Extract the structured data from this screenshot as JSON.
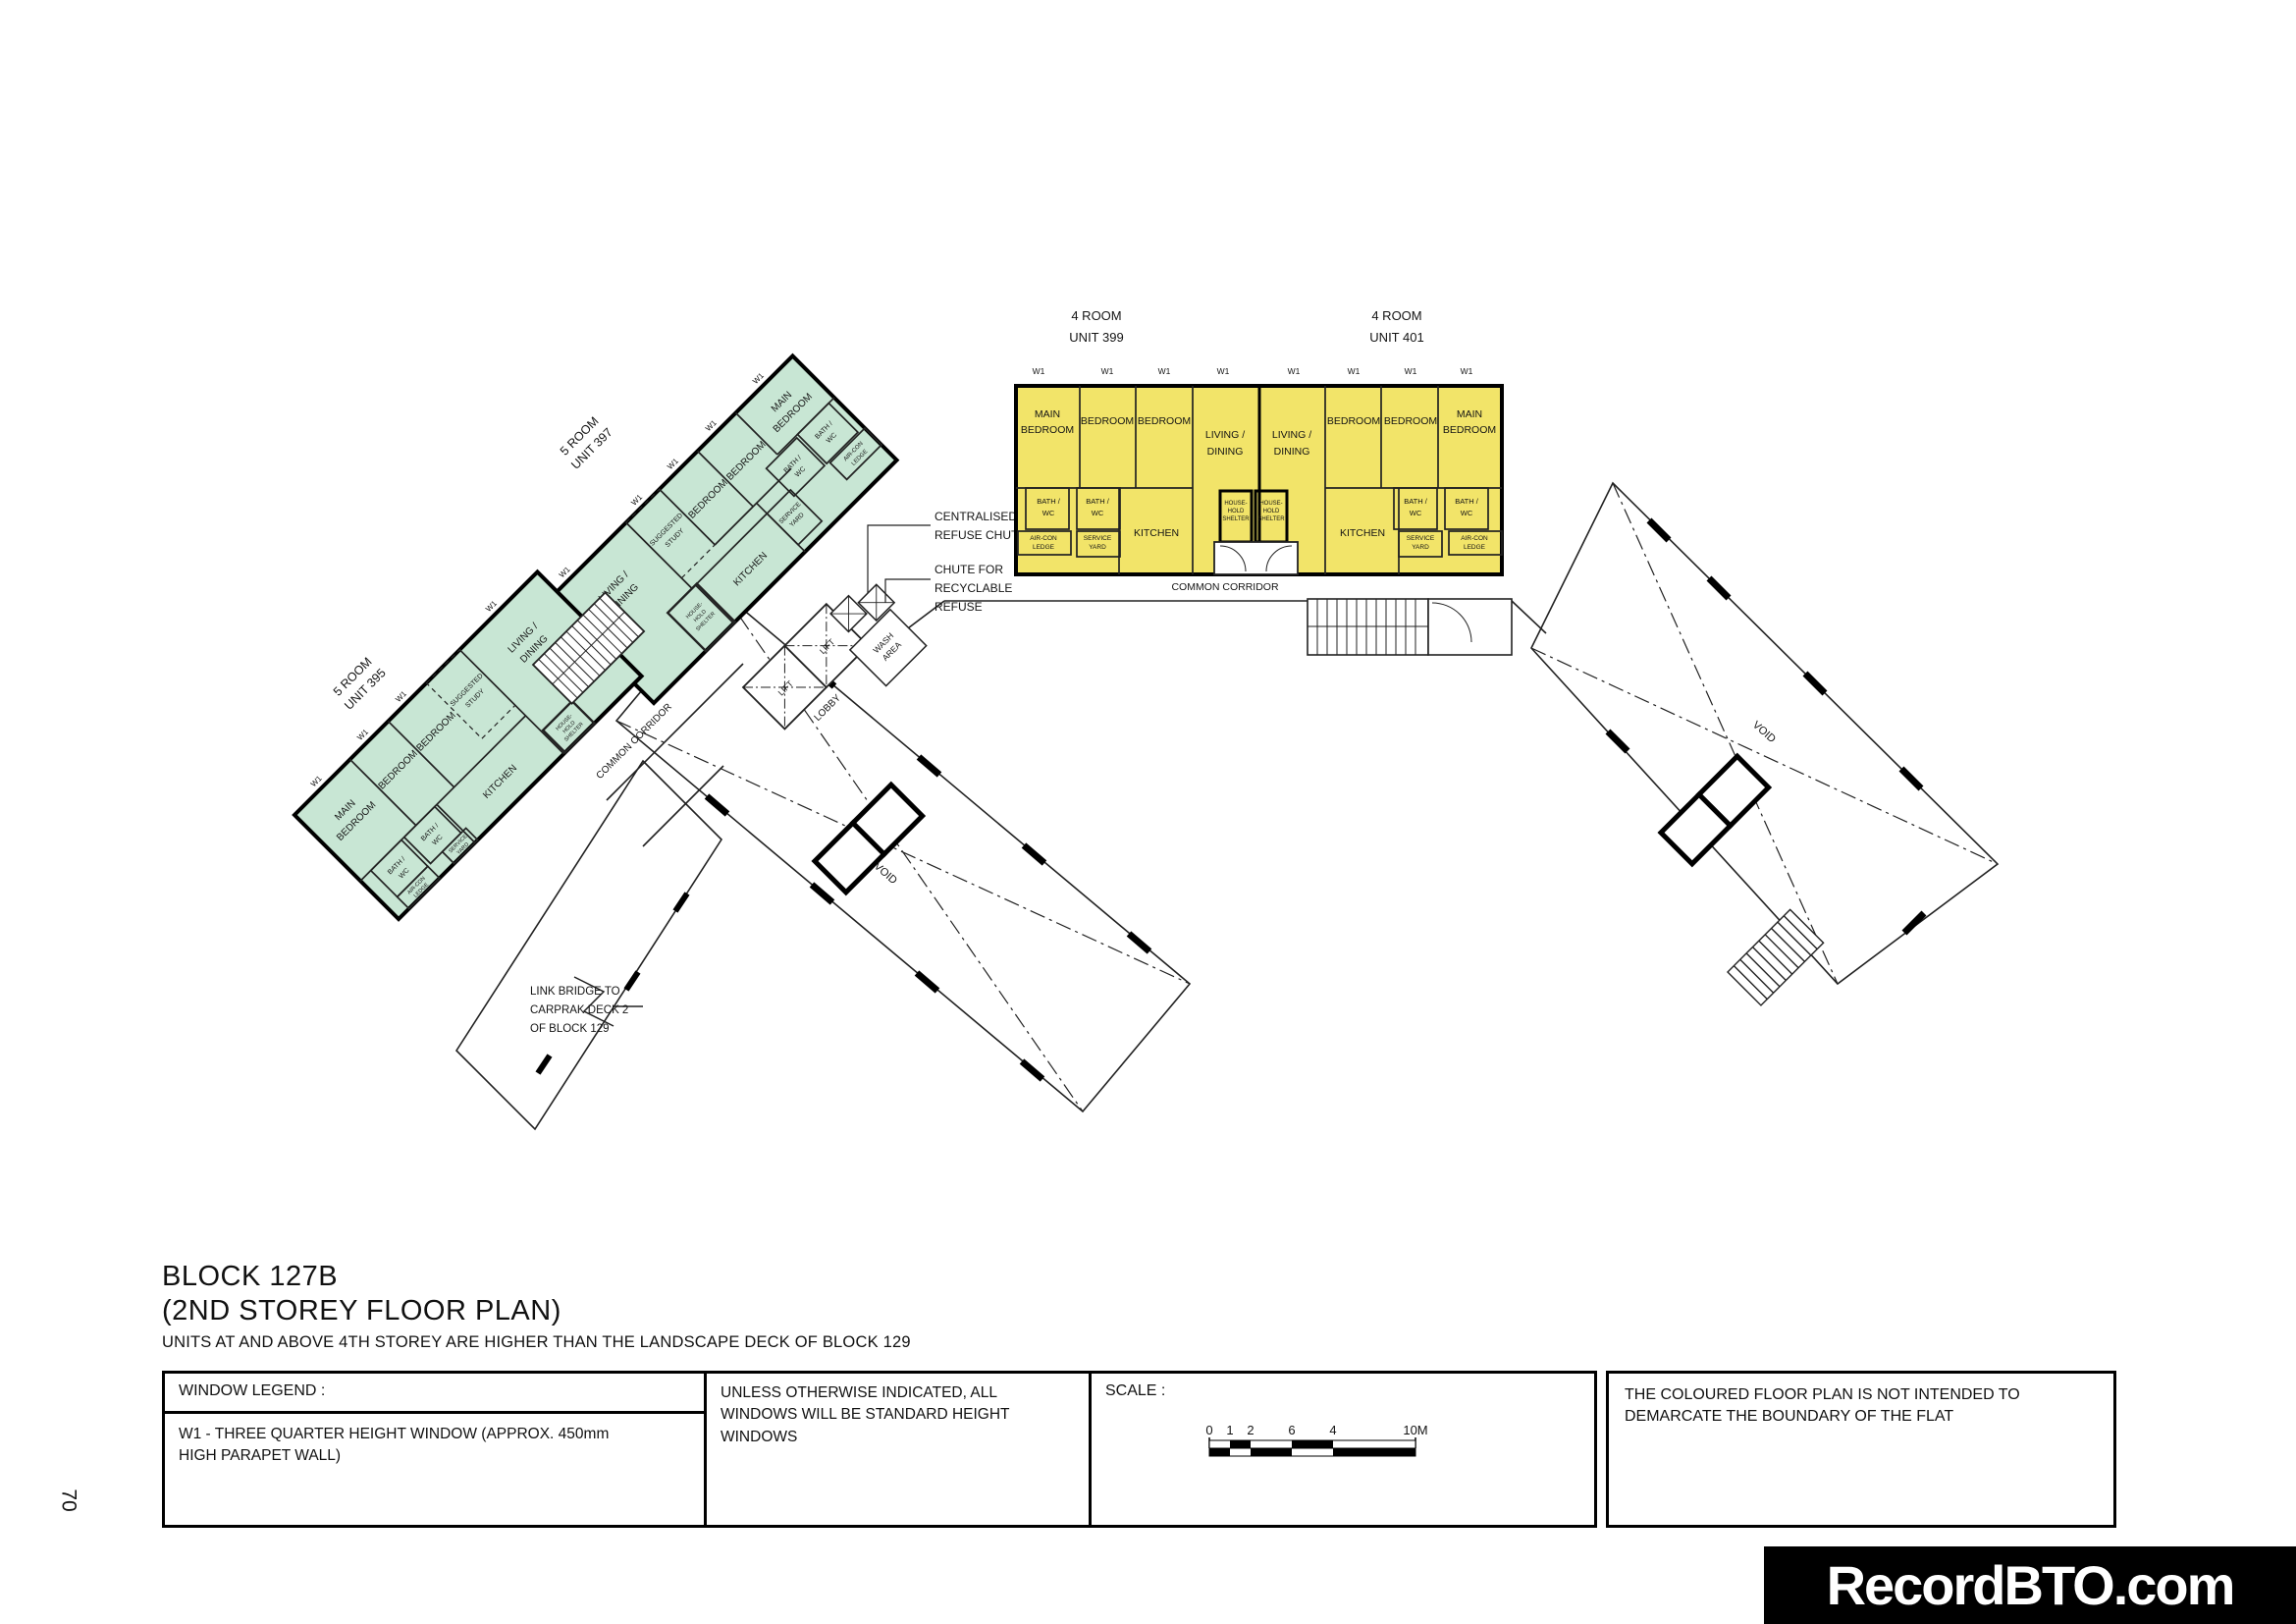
{
  "page": {
    "number": "70",
    "watermark": "RecordBTO.com"
  },
  "colors": {
    "five_room": "#c8e6d4",
    "four_room": "#f2e469",
    "wall": "#141414"
  },
  "title_block": {
    "block": "BLOCK 127B",
    "storey": "(2ND STOREY FLOOR PLAN)",
    "note": "UNITS AT AND ABOVE 4TH STOREY ARE HIGHER THAN THE LANDSCAPE DECK OF BLOCK 129"
  },
  "legend": {
    "window_title": "WINDOW LEGEND :",
    "w1_note": "W1 - THREE QUARTER HEIGHT WINDOW (APPROX. 450mm HIGH PARAPET WALL)",
    "windows_note": "UNLESS OTHERWISE INDICATED, ALL WINDOWS WILL BE STANDARD HEIGHT WINDOWS",
    "scale_title": "SCALE :",
    "scale_ticks": [
      "0",
      "1",
      "2",
      "4",
      "6",
      "10M"
    ],
    "disclaimer": "THE COLOURED FLOOR PLAN IS NOT INTENDED TO DEMARCATE THE BOUNDARY OF THE FLAT"
  },
  "plan": {
    "unit_titles": {
      "u395": {
        "l1": "5 ROOM",
        "l2": "UNIT 395"
      },
      "u397": {
        "l1": "5 ROOM",
        "l2": "UNIT 397"
      },
      "u399": {
        "l1": "4 ROOM",
        "l2": "UNIT 399"
      },
      "u401": {
        "l1": "4 ROOM",
        "l2": "UNIT 401"
      }
    },
    "rooms": {
      "main1": "MAIN",
      "main2": "BEDROOM",
      "bedroom": "BEDROOM",
      "living1": "LIVING /",
      "living2": "DINING",
      "kitchen": "KITCHEN",
      "bath1": "BATH /",
      "bath2": "WC",
      "service1": "SERVICE",
      "service2": "YARD",
      "aircon1": "AIR-CON",
      "aircon2": "LEDGE",
      "hh1": "HOUSE-",
      "hh2": "HOLD",
      "hh3": "SHELTER",
      "study1": "SUGGESTED",
      "study2": "STUDY"
    },
    "areas": {
      "lobby": "LOBBY",
      "void": "VOID",
      "lift": "LIFT",
      "wash1": "WASH",
      "wash2": "AREA",
      "corridor": "COMMON CORRIDOR",
      "w1": "W1"
    },
    "annotations": {
      "refuse1": "CENTRALISED",
      "refuse2": "REFUSE CHUTE",
      "recycle1": "CHUTE FOR",
      "recycle2": "RECYCLABLE",
      "recycle3": "REFUSE",
      "bridge1": "LINK BRIDGE TO",
      "bridge2": "CARPRAK DECK 2",
      "bridge3": "OF BLOCK 129"
    }
  }
}
